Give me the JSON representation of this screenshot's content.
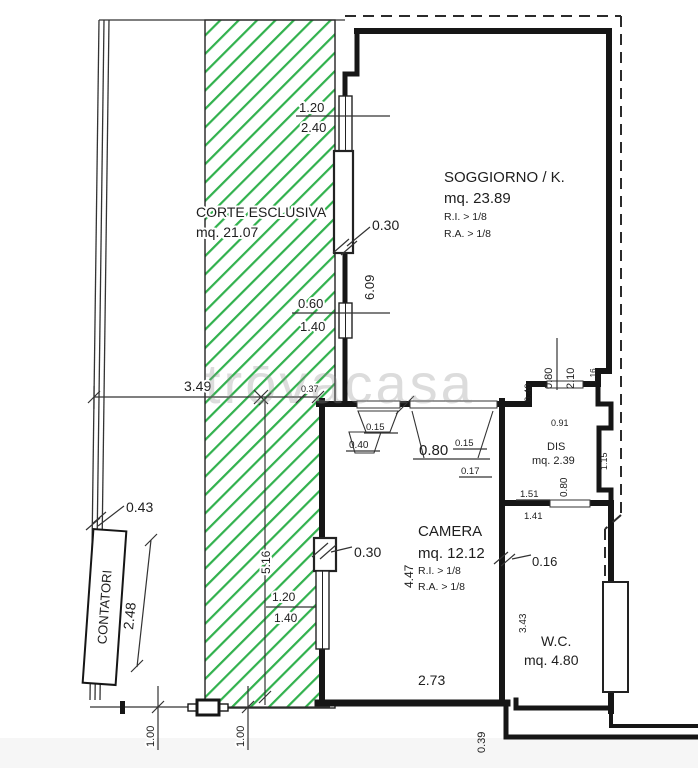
{
  "plan": {
    "watermark": "trōvacasa",
    "rooms": {
      "corte": {
        "label": "CORTE ESCLUSIVA",
        "area": "mq. 21.07"
      },
      "soggiorno": {
        "label": "SOGGIORNO / K.",
        "area": "mq. 23.89",
        "ri": "R.I. > 1/8",
        "ra": "R.A. > 1/8"
      },
      "camera": {
        "label": "CAMERA",
        "area": "mq. 12.12",
        "ri": "R.I. > 1/8",
        "ra": "R.A. > 1/8"
      },
      "dis": {
        "label": "DIS",
        "area": "mq. 2.39"
      },
      "wc": {
        "label": "W.C.",
        "area": "mq. 4.80"
      },
      "contatori": {
        "label": "CONTATORI"
      }
    },
    "dims": {
      "top_window_upper": "1.20",
      "top_window_lower": "2.40",
      "sog_wall_thickness": "0.30",
      "sog_depth": "6.09",
      "mid_window_upper": "0.60",
      "mid_window_lower": "1.40",
      "court_width": "3.49",
      "court_notch": "0.37",
      "dis_door_width": "0.80",
      "dis_door_height": "2.10",
      "dis_notch": "1.16",
      "dis_step": "0.40",
      "dis_width": "0.91",
      "dis_side": "1.15",
      "cam_door_a_upper": "0.15",
      "cam_door_a_lower": "0.40",
      "cam_door_b_width": "0.80",
      "cam_door_b_upper": "0.15",
      "cam_door_b_lower": "0.17",
      "pass_upper": "1.51",
      "pass_lower": "1.41",
      "wc_door_width": "0.80",
      "cam_wall_thickness": "0.16",
      "cam_wall_thickness2": "0.30",
      "cam_window_upper": "1.20",
      "cam_window_lower": "1.40",
      "court_depth": "5.16",
      "cam_depth": "4.47",
      "meter_offset": "0.43",
      "meter_length": "2.48",
      "cam_width": "2.73",
      "wc_depth": "3.43",
      "fence_left": "1.00",
      "fence_right": "1.00",
      "step_depth": "0.39"
    },
    "colors": {
      "hatch_green": "#31b14d",
      "wall_black": "#161616",
      "dash_gray": "#2b2b2b"
    }
  }
}
